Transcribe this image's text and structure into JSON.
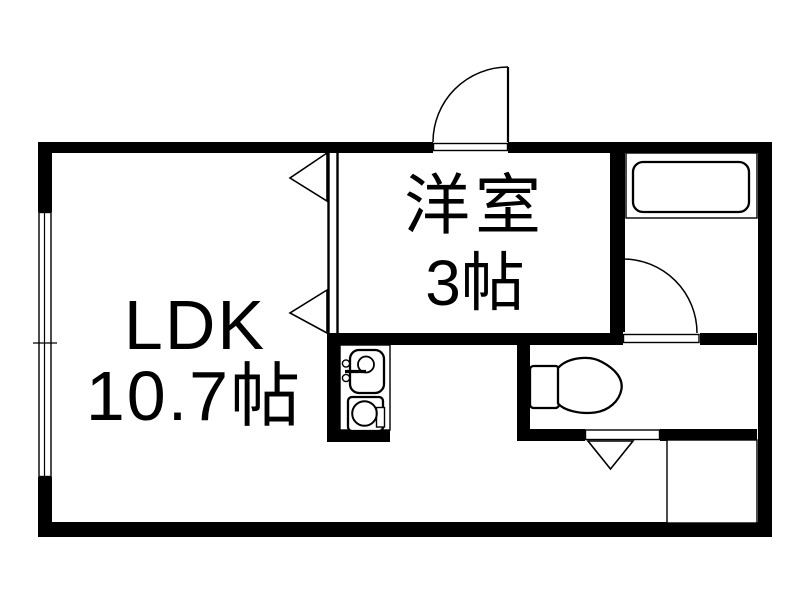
{
  "title": "1LDK apartment floor plan",
  "colors": {
    "wall": "#000000",
    "background": "#ffffff"
  },
  "rooms": {
    "ldk": {
      "name": "LDK",
      "size": "10.7帖"
    },
    "western_room": {
      "name": "洋室",
      "size": "3帖"
    },
    "bathroom": {
      "name": "浴室"
    },
    "toilet": {
      "name": "トイレ"
    },
    "entrance": {
      "name": "玄関"
    }
  },
  "icons": {
    "bathtub": "bathtub-icon",
    "kitchen_sink": "kitchen-sink-icon",
    "stove_burner": "stove-burner-icon",
    "toilet_bowl": "toilet-icon",
    "door_swing": "door-swing-arc-icon",
    "folding_door": "folding-door-triangle-icon",
    "window": "sliding-window-icon"
  }
}
